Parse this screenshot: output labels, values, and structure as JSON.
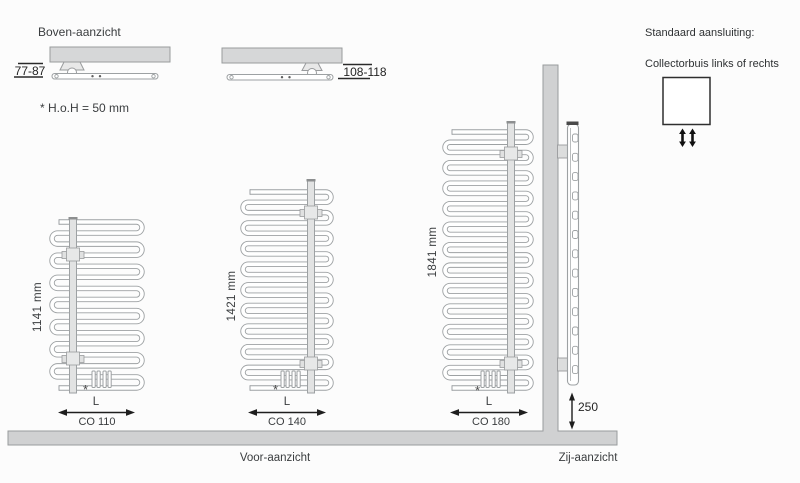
{
  "colors": {
    "background": "#fcfcfc",
    "ink": "#3a3d3f",
    "dimension": "#1e1e1e",
    "steel_fill": "#d0d1d2",
    "steel_edge": "#999b9d",
    "tube_outline": "#9da1a3",
    "collector_fill": "#e2e3e3",
    "bracket_fill": "#e0e1e1",
    "legend_box_edge": "#2f2f2f"
  },
  "top_view": {
    "title": "Boven-aanzicht",
    "note": "* H.o.H = 50 mm",
    "dim_left": "77-87",
    "dim_right": "108-118"
  },
  "connection_legend": {
    "title": "Standaard aansluiting:",
    "subtitle": "Collectorbuis links of rechts"
  },
  "front_view": {
    "label": "Voor-aanzicht",
    "width_dim_label": "L",
    "footnote_mark": "*",
    "radiators": [
      {
        "model": "CO 110",
        "height": "1141 mm",
        "tubes": 16,
        "collector_side": "left"
      },
      {
        "model": "CO 140",
        "height": "1421 mm",
        "tubes": 20,
        "collector_side": "right"
      },
      {
        "model": "CO 180",
        "height": "1841 mm",
        "tubes": 26,
        "collector_side": "right"
      }
    ]
  },
  "side_view": {
    "label": "Zij-aanzicht",
    "floor_distance": "250"
  }
}
